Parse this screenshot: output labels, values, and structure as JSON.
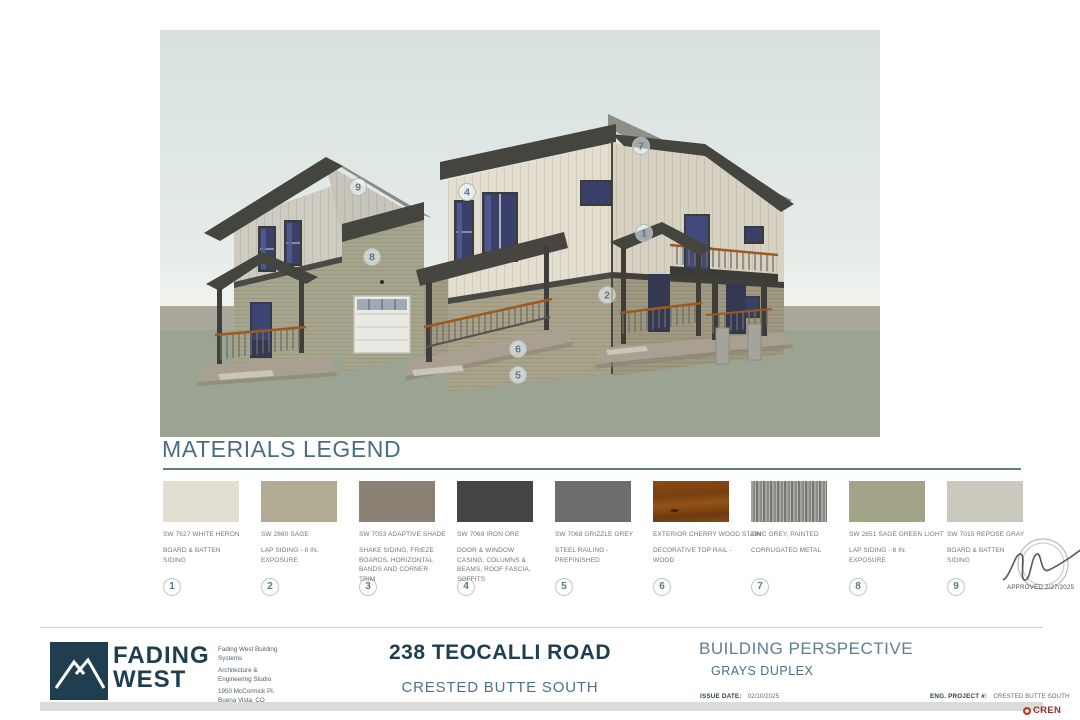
{
  "rendering": {
    "callouts": [
      {
        "num": "1",
        "x": 484,
        "y": 203
      },
      {
        "num": "2",
        "x": 447,
        "y": 265
      },
      {
        "num": "4",
        "x": 307,
        "y": 162
      },
      {
        "num": "5",
        "x": 358,
        "y": 345
      },
      {
        "num": "6",
        "x": 358,
        "y": 319
      },
      {
        "num": "7",
        "x": 481,
        "y": 116
      },
      {
        "num": "8",
        "x": 212,
        "y": 227
      },
      {
        "num": "9",
        "x": 198,
        "y": 157
      }
    ]
  },
  "legend": {
    "title": "MATERIALS LEGEND",
    "items": [
      {
        "num": "1",
        "code": "SW 7627  WHITE HERON",
        "use": "BOARD & BATTEN SIDING",
        "color": "#e3ded2",
        "pattern": "flat"
      },
      {
        "num": "2",
        "code": "SW 2860 SAGE",
        "use": "LAP SIDING - 8 IN. EXPOSURE",
        "color": "#b2ab93",
        "pattern": "flat"
      },
      {
        "num": "3",
        "code": "SW 7053 ADAPTIVE SHADE",
        "use": "SHAKE SIDING, FRIEZE BOARDS, HORIZONTAL BANDS AND CORNER TRIM",
        "color": "#8b8275",
        "pattern": "flat"
      },
      {
        "num": "4",
        "code": "SW 7069 IRON ORE",
        "use": "DOOR & WINDOW CASING, COLUMNS & BEAMS, ROOF FASCIA, SOFFITS",
        "color": "#454442",
        "pattern": "flat"
      },
      {
        "num": "5",
        "code": "SW 7068 GRIZZLE GREY",
        "use": "STEEL RAILING - PREFINISHED",
        "color": "#6d6d6d",
        "pattern": "flat"
      },
      {
        "num": "6",
        "code": "EXTERIOR CHERRY WOOD STAIN",
        "use": "DECORATIVE TOP RAIL - WOOD",
        "color": "#7a4517",
        "pattern": "wood"
      },
      {
        "num": "7",
        "code": "ZINC GREY, PAINTED",
        "use": "CORRUGATED METAL",
        "color": "#8f8f8d",
        "pattern": "corrugated"
      },
      {
        "num": "8",
        "code": "SW 2851 SAGE GREEN LIGHT",
        "use": "LAP SIDING - 8 IN. EXPOSURE",
        "color": "#a3a388",
        "pattern": "flat"
      },
      {
        "num": "9",
        "code": "SW 7015 REPOSE GRAY",
        "use": "BOARD & BATTEN SIDING",
        "color": "#cbc8be",
        "pattern": "flat"
      }
    ]
  },
  "stamp": {
    "text": "APPROVED 2/27/2025"
  },
  "titleblock": {
    "logo_line1": "FADING",
    "logo_line2": "WEST",
    "firm": [
      "Fading West Building Systems",
      "Architecture & Engineering Studio",
      "1950 McCormick Pl. Buena Vista, CO 81211"
    ],
    "address": "238 TEOCALLI ROAD",
    "subdivision": "CRESTED BUTTE SOUTH",
    "sheet_title": "BUILDING PERSPECTIVE",
    "project": "GRAYS DUPLEX",
    "issue_date_label": "ISSUE DATE:",
    "issue_date": "02/10/2025",
    "eng_label": "ENG. PROJECT #:",
    "eng_value": "CRESTED BUTTE SOUTH",
    "cren": "CREN"
  }
}
